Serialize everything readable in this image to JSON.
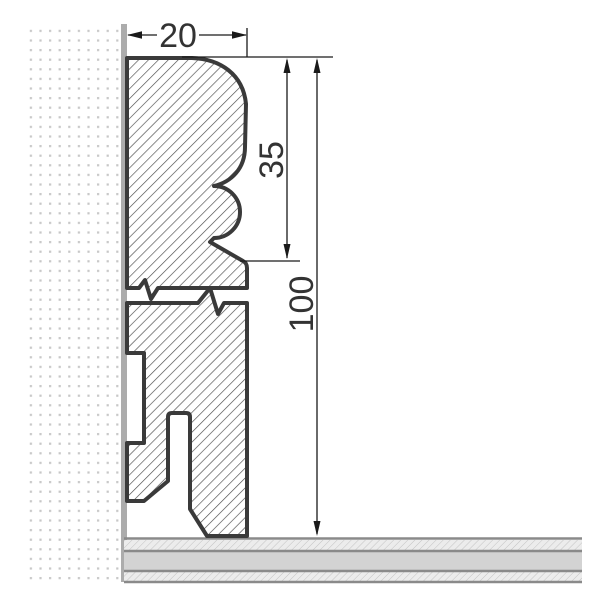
{
  "drawing": {
    "dimension_labels": {
      "width": "20",
      "upper_profile_height": "35",
      "total_height": "100"
    },
    "colors": {
      "profile_outline": "#3a3a3a",
      "profile_hatch_line": "#4a4a4a",
      "dimension_line": "#1a1a1a",
      "label_text": "#333333",
      "wall_dot": "#c7c7c7",
      "wall_surface": "#acacac",
      "floor_underlay": "#d3d3d3",
      "floor_hatch_bg": "#ececec",
      "floor_hatch_line": "#c3c3c3",
      "floor_border": "#8a8a8a"
    }
  }
}
